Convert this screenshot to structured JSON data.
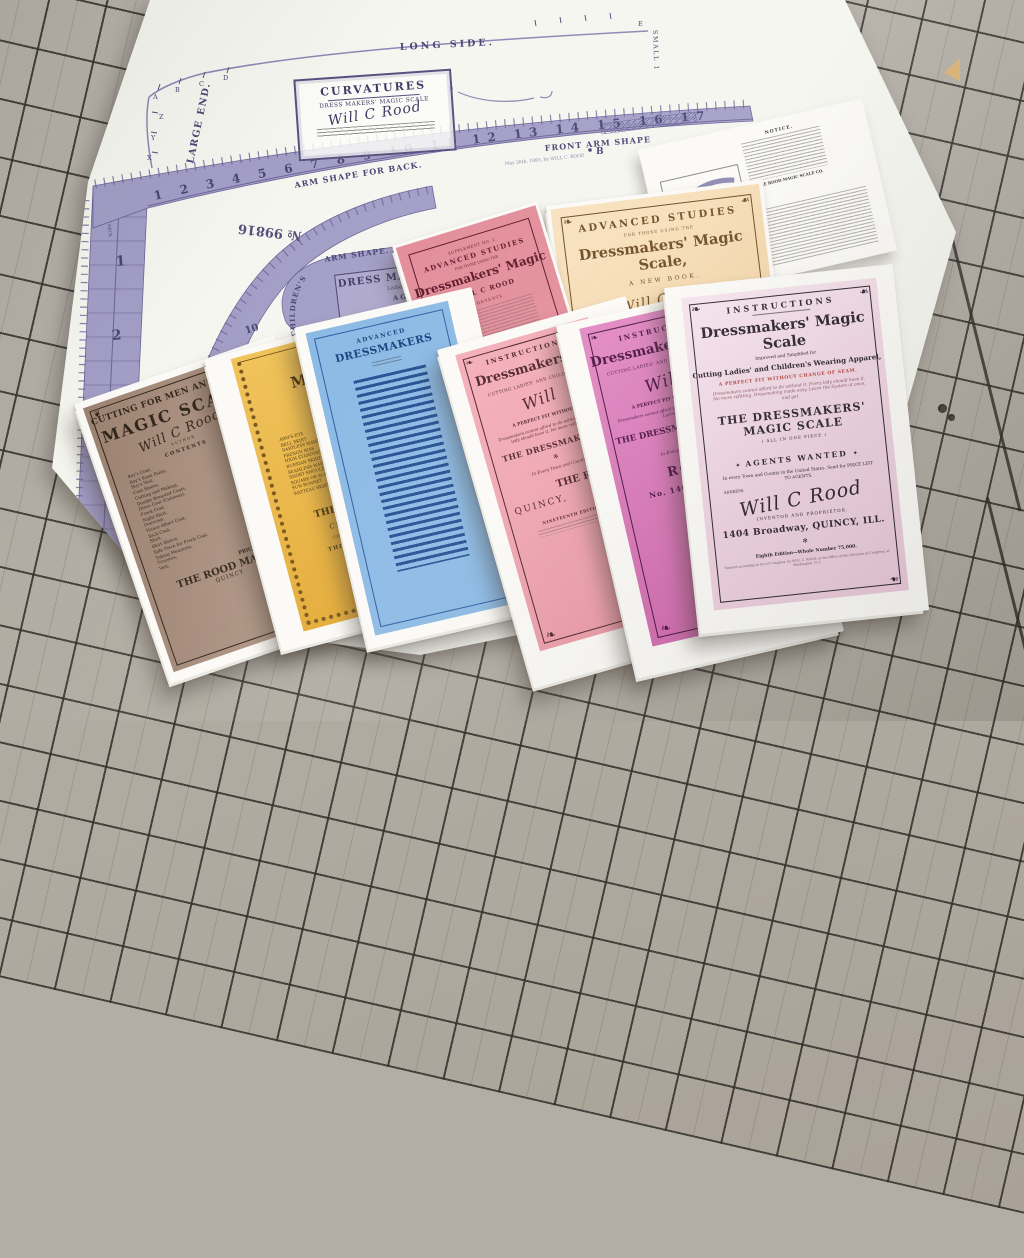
{
  "colors": {
    "mat": "#b3aea5",
    "mat_grid": "#32302b",
    "sheet_white": "#f6f6f0",
    "template_ink": "#a39ec6",
    "template_ink_dark": "#4a4574",
    "brown": "#a8907f",
    "yellow": "#e8b13f",
    "blue": "#85b7e3",
    "blue_dark": "#1d4a8c",
    "rose": "#e28d99",
    "peach": "#f6dcb4",
    "salmon": "#f0a6b0",
    "orchid": "#d678b6",
    "pale_pink": "#f4dde8",
    "red_accent": "#b2443c",
    "teal": "#79ccd3"
  },
  "glyphs": {
    "corner_fleuron": "❧",
    "divider": "✻",
    "banner_flourish": "✦",
    "bird_ornament": "❦"
  },
  "template_sheet": {
    "long_side": "LONG SIDE.",
    "large_end": "LARGE END.",
    "small_end": "SMALL 1",
    "curve_letters": [
      "A",
      "B",
      "C",
      "D",
      "E",
      "X",
      "Y",
      "Z",
      "D"
    ],
    "label_box": {
      "title": "CURVATURES",
      "subtitle": "DRESS MAKERS' MAGIC SCALE",
      "signature": "Will C Rood"
    },
    "ruler": {
      "top_numbers": "1    2    3    4    5    6    7    8    9    10    11    12    13    14    15    16    17",
      "left_numbers": [
        "1",
        "2",
        "3",
        "4",
        "5"
      ],
      "arc_numbers": [
        "10",
        "11",
        "12",
        "13"
      ],
      "corner_letter": "W",
      "front_neck": "FRONT NECK",
      "back_waist_line": "BACK WAIST LINE",
      "arm_shape_for_back": "ARM SHAPE FOR BACK.",
      "front_arm_shape": "FRONT ARM SHAPE",
      "front_arm_shape_curve": "FRONT ARM SHAPE.",
      "childrens": "CHILDREN'S",
      "arm_shape": "ARM SHAPE.",
      "stock_number": "№ 99816",
      "patent_line": "May 26th, 1885, by WILL C. ROOD",
      "point_b": "B",
      "point_c": "C",
      "island": {
        "title": "DRESS MAKERS MAGIC SCALE",
        "subtitle": "Ladies' and Childrens' Wearing Apparel",
        "agents": "AGENTS WANTED",
        "signature": "Will C Rood"
      }
    }
  },
  "notice_sheet": {
    "heading": "NOTICE.",
    "company_line": "THE ROOD MAGIC SCALE CO."
  },
  "booklets": {
    "brown": {
      "header": "CUTTING FOR MEN AND BOYS",
      "title": "MAGIC SCALE",
      "signature": "Will C Rood",
      "byline": "AUTHOR",
      "contents_label": "CONTENTS",
      "items": [
        "Boy's Coat,",
        "Boy's Knee Pants,",
        "Boy's Vest,",
        "Coat Sleeve,",
        "Cutting and Making,",
        "Double Breasted Coats,",
        "Dress Coat (Cutaway),",
        "Frock Coat,",
        "Night Shirt,",
        "Overcoat,",
        "Prince Albert Coat,",
        "Sack Coat,",
        "Shirt,",
        "Shirt Sleeve,",
        "Side Piece for Frock Coat,",
        "Taking Measures,",
        "Trousers,",
        "Vest,"
      ],
      "price_line": "PRICE, POSTPAID",
      "publisher": "THE ROOD MAGIC",
      "city": "QUINCY"
    },
    "yellow": {
      "title": "MAGIC",
      "items": [
        "ARM'S-EYE",
        "BELL SKIRT",
        "DARTLESS WAIST",
        "FRENCH BIAS",
        "HIGH-STANDING COLLAR",
        "RUSSIAN SKIRT",
        "SEAMLESS WAIST",
        "SHORT SHOULDER",
        "SQUARE OR SLANT",
        "SUN BONNET",
        "WATTEAU SKIRT"
      ],
      "price_line": "Price",
      "publisher": "THE ROOD M",
      "city": "CHICAGO,",
      "copyright": "COPYRIGHT SECURED, 18",
      "edition": "THIRD EDITION"
    },
    "blue": {
      "header": "ADVANCED",
      "title": "DRESSMAKERS"
    },
    "supplement": {
      "line1": "SUPPLEMENT NO. 2",
      "line2": "ADVANCED STUDIES",
      "line3": "FOR THOSE USING THE",
      "title": "Dressmakers' Magic",
      "author": "WILL C ROOD",
      "contents_label": "CONTENTS"
    },
    "peach": {
      "line1": "ADVANCED STUDIES",
      "line2": "FOR THOSE USING THE",
      "title": "Dressmakers' Magic Scale,",
      "line3": "A NEW BOOK.",
      "signature": "Will C Rood",
      "line4": "PROFUSELY ILLUSTRATED."
    },
    "pink_center": {
      "arc": "INSTRUCTIONS",
      "title": "Dressmakers'",
      "line1": "CUTTING LADIES' AND CHILDREN'S",
      "signature": "Will",
      "line2": "A PERFECT FIT WITHOUT",
      "para": "Dressmakers cannot afford to do without it.  Every lady should have it.  No more refitting.",
      "line3": "THE DRESSMAKERS'",
      "line4": "In Every Town and County",
      "line5": "THE ROOD",
      "city": "QUINCY,",
      "edition": "NINETEENTH EDITION"
    },
    "orchid": {
      "arc": "INSTRUCTIONS",
      "title": "Dressmakers' Magic",
      "line1": "CUTTING LADIES' AND CHILDREN'S WEARING",
      "signature": "Will C",
      "line2": "A PERFECT FIT WITHOUT CHANGE",
      "para": "Dressmakers cannot afford to do without it.  No more refitting.  Learn the System",
      "line3": "THE DRESSMAKERS' MAGIC",
      "line4": "In Every Town and County",
      "line5": "ROOD",
      "address": "No. 1404 Broadway"
    },
    "instructions": {
      "arc": "INSTRUCTIONS",
      "title": "Dressmakers' Magic Scale",
      "sub1": "Improved and Simplified for",
      "sub2": "Cutting Ladies' and Children's Wearing Apparel,",
      "red_line": "A PERFECT FIT WITHOUT CHANGE OF SEAM.",
      "para": "Dressmakers cannot afford to do without it.  Every lady should have it.  No more refitting.  Dressmaking made easy.  Learn the System at once, and get",
      "big_line": "THE DRESSMAKERS' MAGIC SCALE",
      "small_line": "( ALL IN ONE PIECE )",
      "banner": "AGENTS WANTED",
      "para2": "In every Town and County in the United States.  Send for PRICE LIST TO AGENTS.",
      "address_label": "ADDRESS:",
      "signature": "Will C Rood",
      "role": "INVENTOR AND PROPRIETOR.",
      "address": "1404 Broadway, QUINCY, ILL.",
      "edition": "Eighth Edition—Whole Number 75,000.",
      "fineprint": "Entered according to Act of Congress, by WILL C. ROOD, in the Office of the Librarian of Congress, at Washington, D. C."
    }
  }
}
